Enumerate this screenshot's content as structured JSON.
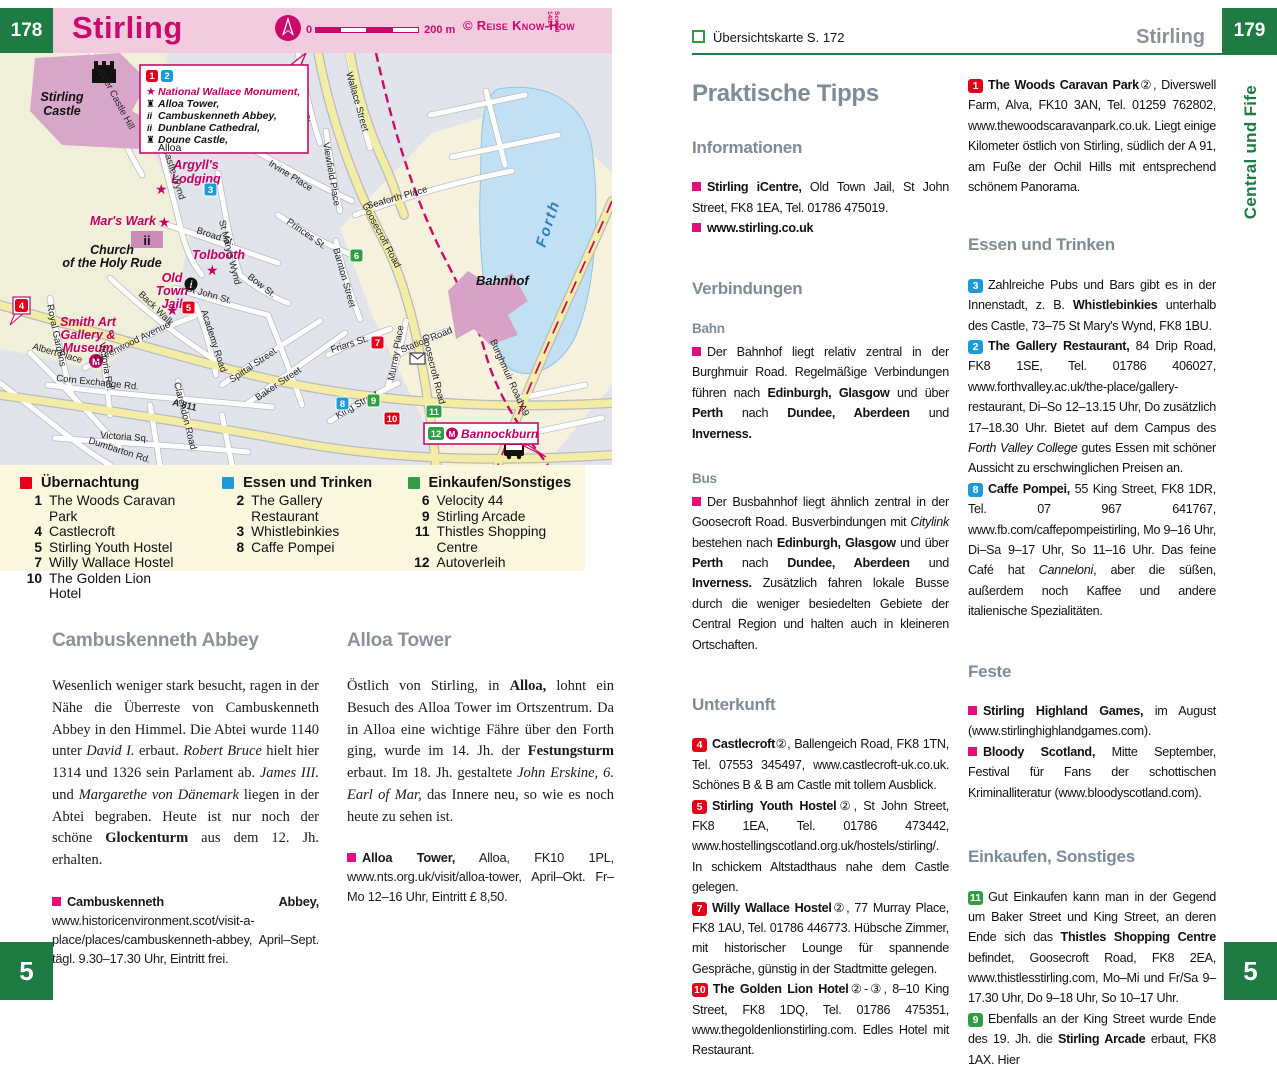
{
  "colors": {
    "brand_magenta": "#cb0a6b",
    "header_pink": "#f2cbdf",
    "page_green": "#1e7b43",
    "legend_red": "#e2001a",
    "legend_blue": "#1e9bd7",
    "legend_green": "#2f9e45",
    "heading_gray": "#7d8c96",
    "bullet_pink": "#e40f7c",
    "water_blue": "#c2e0f4"
  },
  "left_page": {
    "page_number": "178",
    "title": "Stirling",
    "scale_zero": "0",
    "scale_label": "200 m",
    "copyright": "© Reise Know-How",
    "edition_line1": "Scot19",
    "edition_line2": "14/24",
    "map": {
      "callout": {
        "marker1": "1",
        "marker2": "2",
        "line_star": "National Wallace Monument,",
        "line2": "Alloa Tower,",
        "line3": "Cambuskenneth Abbey,",
        "line4": "Dunblane Cathedral,",
        "line5": "Doune Castle,",
        "line6": "Alloa"
      },
      "poi": {
        "stirling_castle_1": "Stirling",
        "stirling_castle_2": "Castle",
        "argylls_1": "Argyll's",
        "argylls_2": "Lodging",
        "mars_wark": "Mar's Wark",
        "church_1": "Church",
        "church_2": "of the Holy Rude",
        "tolbooth": "Tolbooth",
        "jail_1": "Old",
        "jail_2": "Town",
        "jail_3": "Jail",
        "smith_1": "Smith Art",
        "smith_2": "Gallery &",
        "smith_3": "Museum",
        "bahnhof": "Bahnhof",
        "bannockburn": "Bannockburn",
        "forth": "Forth",
        "ii": "ii",
        "i_label": "i",
        "m_label": "M"
      },
      "markers": {
        "m3": "3",
        "m4": "4",
        "m5": "5",
        "m6": "6",
        "m7": "7",
        "m8": "8",
        "m9": "9",
        "m10": "10",
        "m11": "11",
        "m12": "12"
      },
      "streets": {
        "upper_castle_hill": "Upper Castle Hill",
        "castle_wynd": "Castle Wynd",
        "broad_st": "Broad St.",
        "st_john_st": "St John St.",
        "st_marys_wynd": "St Mary's Wynd",
        "bow_st": "Bow St.",
        "irvine_place": "Irvine Place",
        "princes_st": "Princes St.",
        "back_walk": "Back Walk",
        "greenwood_avenue": "Greenwood Avenue",
        "royal_gardens": "Royal Gardens",
        "academy_road": "Academy Road",
        "spittal_street": "Spittal Street",
        "baker_street": "Baker Street",
        "friars_st": "Friars St.",
        "murray_place": "Murray Place",
        "station_road": "Station Road",
        "king_street": "King Street",
        "corn_exchange_rd": "Corn Exchange Rd.",
        "dumbarton_rd": "Dumbarton Rd.",
        "albert_place": "Albert Place",
        "a811": "A 811",
        "victoria_sq": "Victoria Sq.",
        "victoria_rd": "Victoria Rd.",
        "clarendon_road": "Clarendon Road",
        "seaforth_place": "Seaforth Place",
        "viewfield_place": "Viewfield Place",
        "wallace_street": "Wallace Street",
        "cowane_st": "Cowane St.",
        "goosecroft_road": "Goosecroft Road",
        "barnton_street": "Barnton Street",
        "burghmuir_road": "Burghmuir Road  A9"
      }
    },
    "legend": {
      "g1": {
        "title": "Übernachtung",
        "items": [
          {
            "num": "1",
            "label": "The Woods Caravan Park"
          },
          {
            "num": "4",
            "label": "Castlecroft"
          },
          {
            "num": "5",
            "label": "Stirling Youth Hostel"
          },
          {
            "num": "7",
            "label": "Willy Wallace Hostel"
          },
          {
            "num": "10",
            "label": "The Golden Lion Hotel"
          }
        ]
      },
      "g2": {
        "title": "Essen und Trinken",
        "items": [
          {
            "num": "2",
            "label": "The Gallery Restaurant"
          },
          {
            "num": "3",
            "label": "Whistlebinkies"
          },
          {
            "num": "8",
            "label": "Caffe Pompei"
          }
        ]
      },
      "g3": {
        "title": "Einkaufen/Sonstiges",
        "items": [
          {
            "num": "6",
            "label": "Velocity 44"
          },
          {
            "num": "9",
            "label": "Stirling Arcade"
          },
          {
            "num": "11",
            "label": "Thistles Shopping Centre"
          },
          {
            "num": "12",
            "label": "Autoverleih"
          }
        ]
      }
    },
    "articles": {
      "a1_heading": "Cambuskenneth Abbey",
      "a1_body": "Wesenlich weniger stark besucht, ragen in der Nähe die Überreste von Cambuskenneth Abbey in den Himmel. Die Abtei wurde 1140 unter <i>David I.</i> erbaut. <i>Robert Bruce</i> hielt hier 1314 und 1326 sein Parlament ab. <i>James III.</i> und <i>Margarethe von Dänemark</i> liegen in der Abtei begraben. Heute ist nur noch der schöne <b>Glockenturm</b> aus dem 12. Jh. erhalten.",
      "a1_info": "<b>Cambuskenneth Abbey,</b> www.historicenvironment.scot/visit-a-place/places/cambuskenneth-abbey, April–Sept. tägl. 9.30–17.30 Uhr, Eintritt frei.",
      "a2_heading": "Alloa Tower",
      "a2_body": "Östlich von Stirling, in <b>Alloa,</b> lohnt ein Besuch des Alloa Tower im Ortszentrum. Da in Alloa eine wichtige Fähre über den Forth ging, wurde im 14. Jh. der <b>Festungsturm</b> erbaut. Im 18. Jh. gestaltete <i>John Erskine, 6. Earl of Mar,</i> das Innere neu, so wie es noch heute zu sehen ist.",
      "a2_info": "<b>Alloa Tower,</b> Alloa, FK10 1PL, www.nts.org.uk/visit/alloa-tower, April–Okt. Fr–Mo 12–16 Uhr, Eintritt £ 8,50."
    },
    "footer_number": "5"
  },
  "right_page": {
    "header_ref": "Übersichtskarte S. 172",
    "header_title": "Stirling",
    "page_number": "179",
    "sidebar_label": "Central und Fife",
    "col1": {
      "main_heading": "Praktische Tipps",
      "sec_informationen": "Informationen",
      "info1": "<b>Stirling iCentre,</b> Old Town Jail, St John Street, FK8 1EA, Tel. 01786 475019.",
      "info2": "<b>www.stirling.co.uk</b>",
      "sec_verbindungen": "Verbindungen",
      "sub_bahn": "Bahn",
      "bahn_html": "Der Bahnhof liegt relativ zentral in der Burghmuir Road. Regelmäßige Verbindungen führen nach <b>Edinburgh, Glasgow</b> und über <b>Perth</b> nach <b>Dundee, Aberdeen</b> und <b>Inverness.</b>",
      "sub_bus": "Bus",
      "bus_html": "Der Busbahnhof liegt ähnlich zentral in der Goosecroft Road. Busverbindungen mit <i>Citylink</i> bestehen nach <b>Edinburgh, Glasgow</b> und über <b>Perth</b> nach <b>Dundee, Aberdeen</b> und <b>Inverness.</b> Zusätzlich fahren lokale Busse durch die weniger besiedelten Gebiete der Central Region und halten auch in kleineren Ortschaften.",
      "sec_unterkunft": "Unterkunft",
      "entries": [
        {
          "num": "4",
          "color": "red",
          "html": "<b>Castlecroft</b>②, Ballengeich Road, FK8 1TN, Tel. 07553 345497, www.castlecroft-uk.co.uk. Schönes B &amp; B am Castle mit tollem Ausblick."
        },
        {
          "num": "5",
          "color": "red",
          "html": "<b>Stirling Youth Hostel</b>②, St John Street, FK8 1EA, Tel. 01786 473442, www.hostellingscotland.org.uk/hostels/stirling/. In schickem Altstadthaus nahe dem Castle gelegen."
        },
        {
          "num": "7",
          "color": "red",
          "html": "<b>Willy Wallace Hostel</b>②, 77 Murray Place, FK8 1AU, Tel. 01786 446773. Hübsche Zimmer, mit historischer Lounge für spannende Gespräche, günstig in der Stadtmitte gelegen."
        },
        {
          "num": "10",
          "color": "red",
          "html": "<b>The Golden Lion Hotel</b>②-③, 8–10 King Street, FK8 1DQ, Tel. 01786 475351, www.thegoldenlionstirling.com. Edles Hotel mit Restaurant."
        }
      ]
    },
    "col2": {
      "entry_woods": {
        "num": "1",
        "color": "red",
        "html": "<b>The Woods Caravan Park</b>②, Diverswell Farm, Alva, FK10 3AN, Tel. 01259 762802, www.thewoodscaravanpark.co.uk. Liegt einige Kilometer östlich von Stirling, südlich der A 91, am Fuße der Ochil Hills mit entsprechend schönem Panorama."
      },
      "sec_essen": "Essen und Trinken",
      "entries_essen": [
        {
          "num": "3",
          "color": "blue",
          "html": "Zahlreiche Pubs und Bars gibt es in der Innenstadt, z. B. <b>Whistlebinkies</b> unterhalb des Castle, 73–75 St Mary's Wynd, FK8 1BU."
        },
        {
          "num": "2",
          "color": "blue",
          "html": "<b>The Gallery Restaurant,</b> 84 Drip Road, FK8 1SE, Tel. 01786 406027, www.forthvalley.ac.uk/the-place/gallery-restaurant, Di–So 12–13.15 Uhr, Do zusätzlich 17–18.30 Uhr. Bietet auf dem Campus des <i>Forth Valley College</i> gutes Essen mit schöner Aussicht zu erschwinglichen Preisen an."
        },
        {
          "num": "8",
          "color": "blue",
          "html": "<b>Caffe Pompei,</b> 55 King Street, FK8 1DR, Tel. 07 967 641767, www.fb.com/caffepompeistirling, Mo 9–16 Uhr, Di–Sa 9–17 Uhr, So 11–16 Uhr. Das feine Café hat <i>Canneloni</i>, aber die süßen, außerdem noch Kaffee und andere italienische Spezialitäten."
        }
      ],
      "sec_feste": "Feste",
      "feste1_html": "<b>Stirling Highland Games,</b> im August (www.stirlinghighlandgames.com).",
      "feste2_html": "<b>Bloody Scotland,</b> Mitte September, Festival für Fans der schottischen Kriminalliteratur (www.bloodyscotland.com).",
      "sec_einkaufen": "Einkaufen, Sonstiges",
      "entries_einkaufen": [
        {
          "num": "11",
          "color": "green",
          "html": "Gut Einkaufen kann man in der Gegend um Baker Street und King Street, an deren Ende sich das <b>Thistles Shopping Centre</b> befindet, Goosecroft Road, FK8 2EA, www.thistlesstirling.com, Mo–Mi und Fr/Sa 9–17.30 Uhr, Do 9–18 Uhr, So 10–17 Uhr."
        },
        {
          "num": "9",
          "color": "green",
          "html": "Ebenfalls an der King Street wurde Ende des 19. Jh. die <b>Stirling Arcade</b> erbaut, FK8 1AX. Hier"
        }
      ]
    },
    "footer_number": "5"
  }
}
